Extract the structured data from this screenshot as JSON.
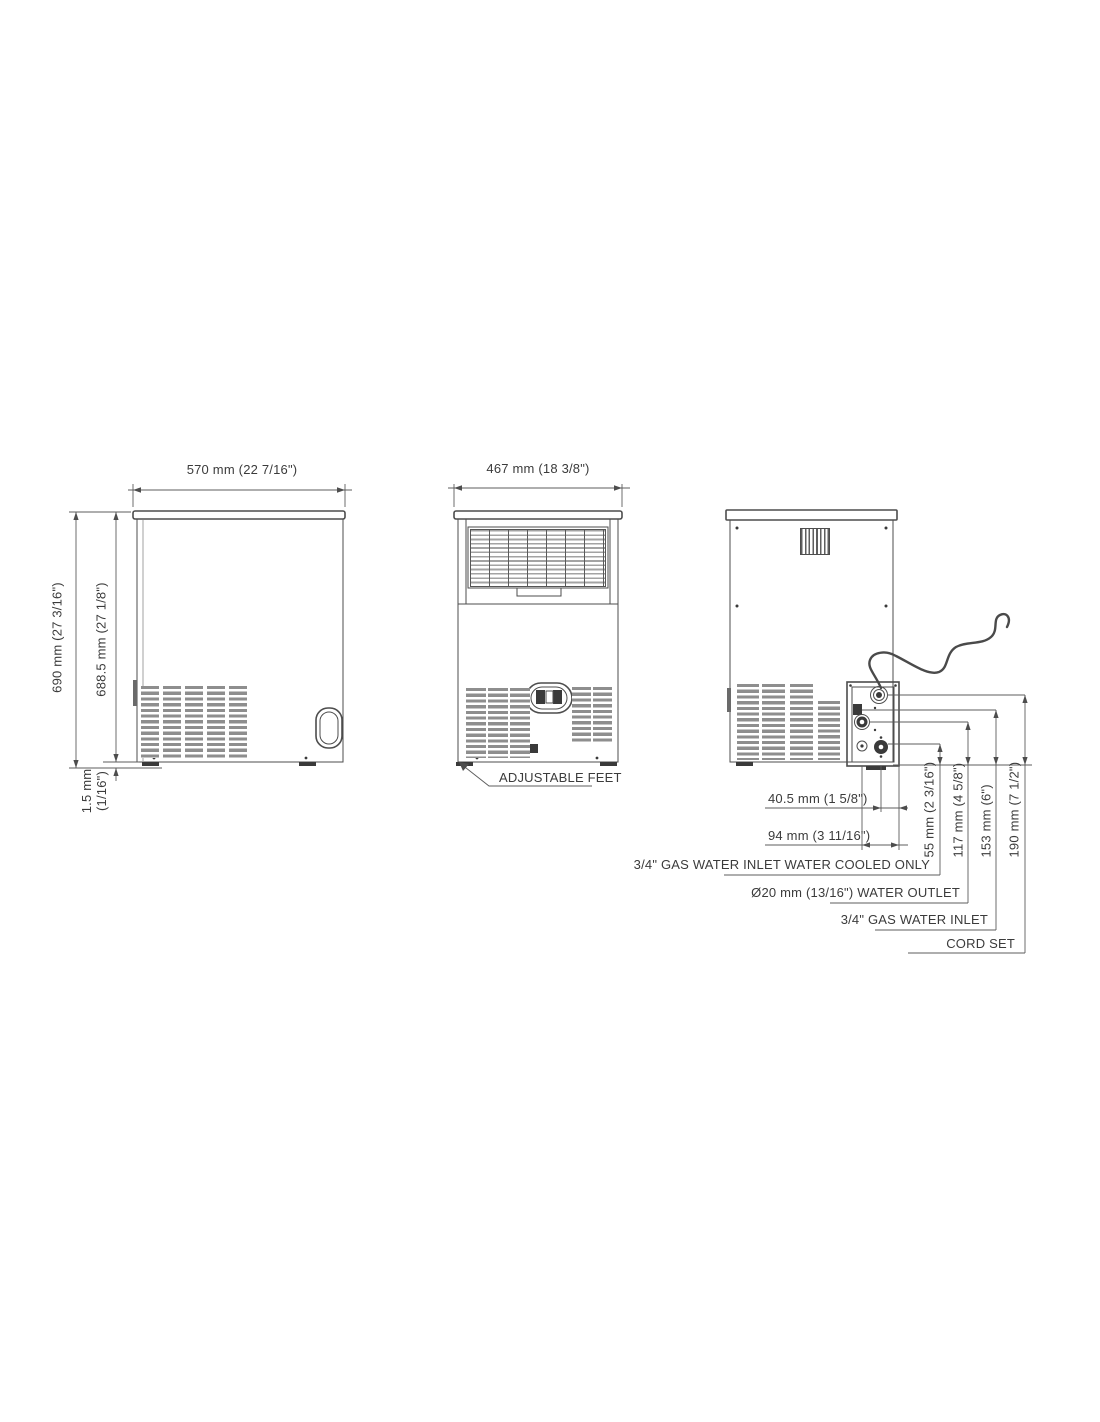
{
  "colors": {
    "line": "#4d4d4d",
    "text": "#3b3b3b",
    "vent": "#8e8e8e"
  },
  "side_view": {
    "width_dim": "570 mm (22 7/16\")",
    "height_dim": "690 mm (27 3/16\")",
    "inner_height_dim": "688.5 mm (27 1/8\")",
    "base_gap_dim_l1": "1.5 mm",
    "base_gap_dim_l2": "(1/16\")"
  },
  "front_view": {
    "width_dim": "467 mm (18 3/8\")",
    "feet_label": "ADJUSTABLE FEET"
  },
  "rear_view": {
    "offset_dims": [
      "40.5 mm (1 5/8\")",
      "94 mm (3 11/16\")"
    ],
    "height_dims": [
      "55 mm (2 3/16\")",
      "117 mm (4 5/8\")",
      "153 mm (6\")",
      "190 mm (7 1/2\")"
    ],
    "connection_labels": [
      "3/4\" GAS WATER INLET WATER COOLED ONLY",
      "Ø20 mm (13/16\") WATER OUTLET",
      "3/4\" GAS WATER INLET",
      "CORD SET"
    ]
  }
}
